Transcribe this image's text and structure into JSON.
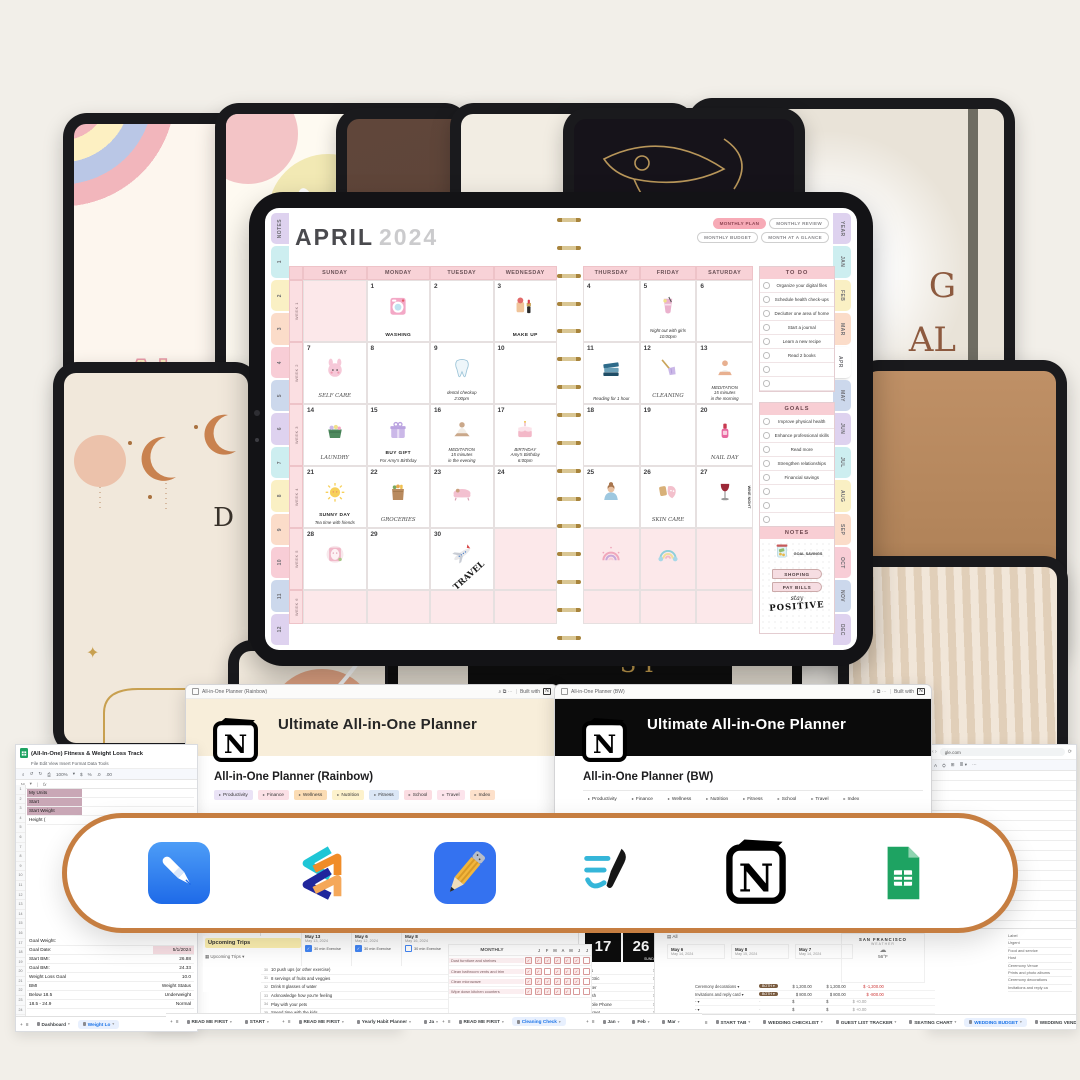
{
  "covers": {
    "rainbow_l1": "AL",
    "rainbow_l2": "PLA",
    "sun_l1": "G",
    "sun_l2": "AL",
    "boho_letter": "D",
    "strip_text": "SI"
  },
  "planner": {
    "month": "APRIL",
    "year": "2024",
    "buttons": [
      "MONTHLY PLAN",
      "MONTHLY REVIEW",
      "MONTHLY BUDGET",
      "MONTH AT A GLANCE"
    ],
    "left_tabs": [
      "NOTES",
      "1",
      "2",
      "3",
      "4",
      "5",
      "6",
      "7",
      "8",
      "9",
      "10",
      "11",
      "12"
    ],
    "right_tabs": [
      "YEAR",
      "JAN",
      "FEB",
      "MAR",
      "APR",
      "MAY",
      "JUN",
      "JUL",
      "AUG",
      "SEP",
      "OCT",
      "NOV",
      "DEC"
    ],
    "active_right_tab": "APR",
    "day_headers": [
      "SUNDAY",
      "MONDAY",
      "TUESDAY",
      "WEDNESDAY",
      "THURSDAY",
      "FRIDAY",
      "SATURDAY"
    ],
    "week_labels": [
      "WEEK 1",
      "WEEK 2",
      "WEEK 3",
      "WEEK 4",
      "WEEK 5",
      "WEEK 6"
    ],
    "days": [
      {
        "n": "1",
        "sticker": "washing",
        "label": "WASHING"
      },
      {
        "n": "2"
      },
      {
        "n": "3",
        "sticker": "makeup",
        "label": "MAKE UP"
      },
      {
        "n": "4"
      },
      {
        "n": "5",
        "sticker": "drink",
        "note": [
          "Night out with girls",
          "10:00pm"
        ]
      },
      {
        "n": "6"
      },
      {
        "n": "7",
        "sticker": "selfcare",
        "script": "SELF CARE"
      },
      {
        "n": "8"
      },
      {
        "n": "9",
        "sticker": "tooth",
        "note": [
          "dental checkup",
          "2:00pm"
        ]
      },
      {
        "n": "10"
      },
      {
        "n": "11",
        "sticker": "books",
        "note": [
          "Reading for 1 hour"
        ]
      },
      {
        "n": "12",
        "sticker": "broom",
        "script": "CLEANING"
      },
      {
        "n": "13",
        "sticker": "yoga",
        "note": [
          "MEDITATION",
          "15 minutes",
          "in the morning"
        ]
      },
      {
        "n": "14",
        "sticker": "laundry",
        "script": "LAUNDRY"
      },
      {
        "n": "15",
        "sticker": "gift",
        "label": "BUY GIFT",
        "note": [
          "For Amy's Birthday"
        ]
      },
      {
        "n": "16",
        "sticker": "meditate",
        "note": [
          "MEDITATION",
          "15 minutes",
          "in the evening"
        ]
      },
      {
        "n": "17",
        "sticker": "cake",
        "note": [
          "BIRTHDAY",
          "Amy's Birthday",
          "6:00pm"
        ]
      },
      {
        "n": "18"
      },
      {
        "n": "19"
      },
      {
        "n": "20",
        "sticker": "nail",
        "script": "NAIL DAY"
      },
      {
        "n": "21",
        "sticker": "sun",
        "label": "SUNNY DAY",
        "note": [
          "Tea time with friends"
        ]
      },
      {
        "n": "22",
        "sticker": "groceries",
        "script": "GROCERIES"
      },
      {
        "n": "23",
        "sticker": "bath"
      },
      {
        "n": "24"
      },
      {
        "n": "25",
        "sticker": "woman"
      },
      {
        "n": "26",
        "sticker": "skincare",
        "script": "SKIN CARE"
      },
      {
        "n": "27",
        "sticker": "wine",
        "vlabel": "WINE NIGHT"
      },
      {
        "n": "28",
        "sticker": "facemask"
      },
      {
        "n": "29"
      },
      {
        "n": "30",
        "sticker": "plane",
        "diag": "TRAVEL"
      }
    ],
    "todo": {
      "title": "TO DO",
      "items": [
        "Organize your digital files",
        "Schedule health check-ups",
        "Declutter one area of home",
        "Start a journal",
        "Learn a new recipe",
        "Read 2 books",
        "",
        ""
      ]
    },
    "goals": {
      "title": "GOALS",
      "items": [
        "Improve physical health",
        "Enhance professional skills",
        "Read more",
        "Strengthen relationships",
        "Financial savings",
        "",
        "",
        ""
      ]
    },
    "notes": {
      "title": "NOTES",
      "jar_label": "GOAL SAVINGS",
      "tags": [
        "SHOPING",
        "PAY BILLS"
      ],
      "quote_script": "stay",
      "quote_word": "POSITIVE"
    }
  },
  "notion": [
    {
      "window_title": "All-in-One Planner (Rainbow)",
      "controls": "⌕ ⧉ ⋯",
      "built_with": "Built with",
      "banner_title": "Ultimate All-in-One Planner",
      "heading": "All-in-One Planner (Rainbow)",
      "toggles": [
        {
          "label": "Productivity",
          "bg": "#eae3f6"
        },
        {
          "label": "Finance",
          "bg": "#fbe0e6"
        },
        {
          "label": "Wellness",
          "bg": "#fbdcb4"
        },
        {
          "label": "Nutrition",
          "bg": "#fdf2cc"
        },
        {
          "label": "Fitness",
          "bg": "#dbe7f6"
        },
        {
          "label": "School",
          "bg": "#fbdde2"
        },
        {
          "label": "Travel",
          "bg": "#fce4ec"
        },
        {
          "label": "Index",
          "bg": "#fde1cb"
        }
      ]
    },
    {
      "window_title": "All-in-One Planner (BW)",
      "controls": "⌕ ⧉ ⋯",
      "built_with": "Built with",
      "banner_title": "Ultimate All-in-One Planner",
      "heading": "All-in-One Planner (BW)",
      "toggles": [
        {
          "label": "Productivity",
          "bg": "transparent"
        },
        {
          "label": "Finance",
          "bg": "transparent"
        },
        {
          "label": "Wellness",
          "bg": "transparent"
        },
        {
          "label": "Nutrition",
          "bg": "transparent"
        },
        {
          "label": "Fitness",
          "bg": "transparent"
        },
        {
          "label": "School",
          "bg": "transparent"
        },
        {
          "label": "Travel",
          "bg": "transparent"
        },
        {
          "label": "Index",
          "bg": "transparent"
        }
      ]
    }
  ],
  "apps": [
    {
      "name": "GoodNotes",
      "icon": "goodnotes-icon"
    },
    {
      "name": "Xodo",
      "icon": "xodo-icon"
    },
    {
      "name": "Notability",
      "icon": "notability-icon"
    },
    {
      "name": "Noteful",
      "icon": "noteful-icon"
    },
    {
      "name": "Notion",
      "icon": "notion-icon"
    },
    {
      "name": "Google Sheets",
      "icon": "google-sheets-icon"
    }
  ],
  "ui": {
    "built_with": "Built with",
    "add_tab": "+",
    "all_sheets": "≡",
    "fx": "fx",
    "zoom": "100%",
    "controls": "⌕ ⧉ ⋯"
  },
  "sheets": {
    "fitness": {
      "title": "(All-In-One) Fitness & Weight Loss Track",
      "menu": "File   Edit   View   Insert   Format   Data   Tools",
      "cell_ref": "M",
      "top_rows": [
        "My Units",
        "Start",
        "Start Weight",
        "Height ("
      ],
      "rows": [
        [
          "Goal Weight:",
          ""
        ],
        [
          "Goal Date:",
          "5/1/2024"
        ],
        [
          "Start BMI:",
          "26.88"
        ],
        [
          "Goal BMI:",
          "24.33"
        ],
        [
          "Weight Loss Goal",
          "10.0"
        ],
        [
          "BMI",
          "Weight Status"
        ],
        [
          "Below 18.5",
          "Underweight"
        ],
        [
          "18.5 - 24.9",
          "Normal"
        ]
      ],
      "tabs": [
        "Dashboard",
        "Weight Lo"
      ],
      "active_tab": 1
    },
    "second": {
      "title": "(All-In-One)",
      "menu": "File  Edit  Vie"
    },
    "trips": {
      "header": "Upcoming Trips",
      "subrow": "Upcoming Trips",
      "tabs": [
        "READ ME FIRST",
        "START"
      ],
      "active_tab": 0
    },
    "daily": {
      "dates": [
        {
          "day": "May 13",
          "date": "May 13, 2024",
          "task": "30 min Exercise",
          "checked": true
        },
        {
          "day": "May 6",
          "date": "May 12, 2024",
          "task": "30 min Exercise",
          "checked": true
        },
        {
          "day": "May 8",
          "date": "May 16, 2024",
          "task": "30 min Exercise",
          "checked": false
        }
      ]
    },
    "habits": {
      "row_numbers": [
        "30",
        "31",
        "32",
        "33",
        "34",
        "35"
      ],
      "rows": [
        "10 push ups (or other exercise)",
        "8 servings of fruits and veggies",
        "Drink 8 glasses of water",
        "Acknowledge how you're feeling",
        "Play with your pets",
        "Spend time with the kids"
      ],
      "tabs": [
        "READ ME FIRST",
        "Yearly Habit Planner",
        "Ja"
      ],
      "active_tab": 0
    },
    "cleaning": {
      "title": "MONTHLY",
      "columns": [
        "J",
        "F",
        "M",
        "A",
        "M",
        "J",
        "J"
      ],
      "rows": [
        "Dust furniture and shelves",
        "Clean bathroom vents and trim",
        "Clean microwave",
        "Wipe down kitchen counters"
      ],
      "tabs": [
        "READ ME FIRST",
        "Cleaning Check"
      ],
      "active_tab": 1
    },
    "utilities": {
      "date_left": "17",
      "date_right": "26",
      "date_label": "SUNDAY",
      "rows": [
        [
          "Gas",
          ""
        ],
        [
          "Electric",
          "$ 150"
        ],
        [
          "Water",
          "$ 50"
        ],
        [
          "Trash",
          "$ 40"
        ],
        [
          "Mobile Phone",
          "$ 200"
        ],
        [
          "Internet",
          "$ 80"
        ]
      ],
      "tabs": [
        "Jan",
        "Feb",
        "Mar"
      ]
    },
    "wedding": {
      "filter": "All",
      "weather_city": "SAN FRANCISCO",
      "weather_sub": "WEATHER",
      "weather_temp": "56°F",
      "dates": [
        {
          "day": "May 6",
          "date": "May 14, 2024"
        },
        {
          "day": "May 8",
          "date": "May 15, 2024"
        },
        {
          "day": "May 7",
          "date": "May 14, 2024"
        }
      ],
      "rows": [
        [
          "Ceremony decorations",
          "BOTH",
          "$ 1,200.00",
          "$ 1,200.00",
          "$ -1,200.00"
        ],
        [
          "Invitations and reply card",
          "BOTH",
          "$ 800.00",
          "$ 800.00",
          "$ -800.00"
        ],
        [
          "-",
          "-",
          "$",
          "$",
          "$ +0.00"
        ],
        [
          "-",
          "-",
          "$",
          "$",
          "$ +0.00"
        ],
        [
          "-",
          "-",
          "$",
          "$",
          "$ +0.00"
        ]
      ],
      "side_list": [
        "Label",
        "Urgent",
        "Food and service",
        "Host",
        "Ceremony Venue",
        "Prints and photo albums",
        "Ceremony decorations",
        "Invitations and reply ca"
      ],
      "tabs": [
        "START TAB",
        "WEDDING CHECKLIST",
        "GUEST LIST TRACKER",
        "SEATING CHART",
        "WEDDING BUDGET",
        "WEDDING VENDORS"
      ],
      "active_tab": 4
    },
    "partial": {
      "url": "gle.com"
    }
  }
}
